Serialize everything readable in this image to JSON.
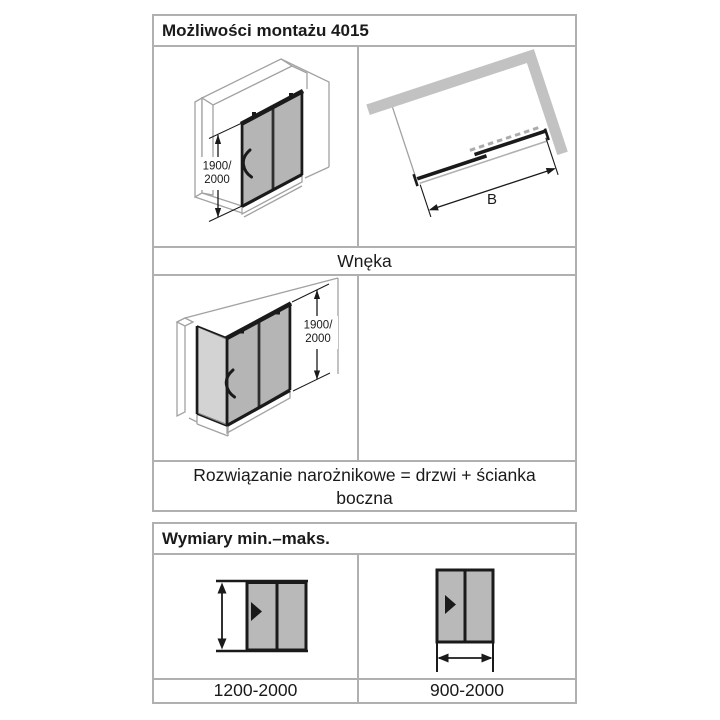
{
  "montaz_table": {
    "title": "Możliwości montażu 4015",
    "niche_caption": "Wnęka",
    "corner_caption": "Rozwiązanie narożnikowe = drzwi + ścianka boczna",
    "height_dimension": {
      "line1": "1900/",
      "line2": "2000"
    },
    "width_dimension_label": "B"
  },
  "wymiary_table": {
    "title": "Wymiary min.–maks.",
    "left_range": "1200-2000",
    "right_range": "900-2000"
  },
  "colors": {
    "table_border": "#b0b0b0",
    "drawing_line_gray": "#a2a2a2",
    "wall_gray": "#c2c2c2",
    "glass_gray": "#b5b5b5",
    "glass_gray_light": "#d3d3d3",
    "pictogram_gray": "#b9b9b9",
    "ink": "#1a1a1a"
  }
}
